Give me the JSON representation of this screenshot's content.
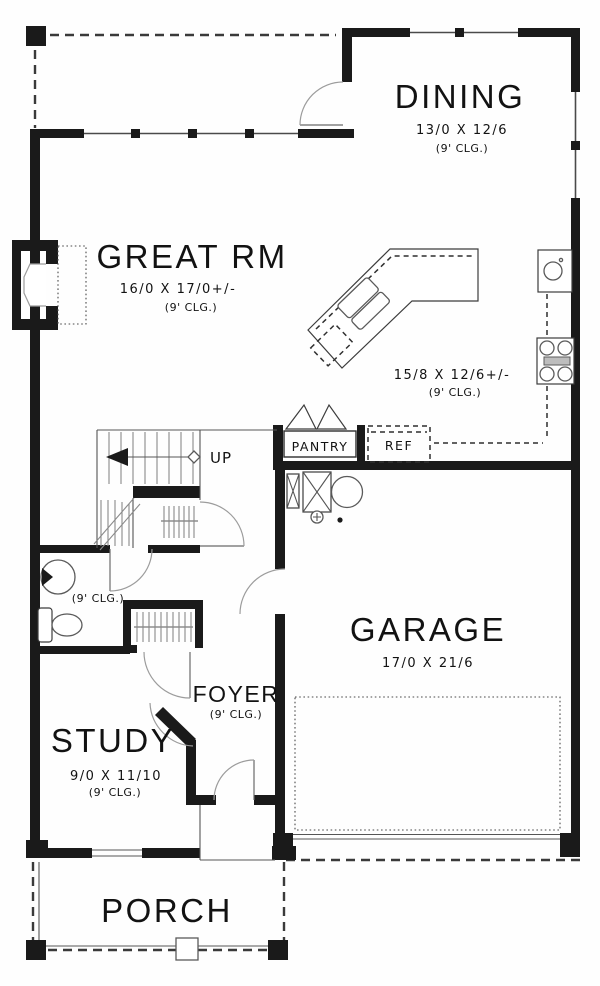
{
  "colors": {
    "ink": "#1a1a1a",
    "line_gray": "#9c9c9c",
    "background": "#fefefe"
  },
  "rooms": {
    "dining": {
      "name": "DINING",
      "dims": "13/0 X 12/6",
      "clg": "(9' CLG.)"
    },
    "great_rm": {
      "name": "GREAT RM",
      "dims": "16/0 X 17/0+/-",
      "clg": "(9' CLG.)"
    },
    "kitchen": {
      "dims": "15/8 X 12/6+/-",
      "clg": "(9' CLG.)"
    },
    "pantry": {
      "name": "PANTRY"
    },
    "ref": {
      "name": "REF"
    },
    "stairs": {
      "direction_label": "UP"
    },
    "powder": {
      "clg": "(9' CLG.)"
    },
    "garage": {
      "name": "GARAGE",
      "dims": "17/0 X 21/6"
    },
    "foyer": {
      "name": "FOYER",
      "clg": "(9' CLG.)"
    },
    "study": {
      "name": "STUDY",
      "dims": "9/0 X 11/10",
      "clg": "(9' CLG.)"
    },
    "porch": {
      "name": "PORCH"
    }
  }
}
